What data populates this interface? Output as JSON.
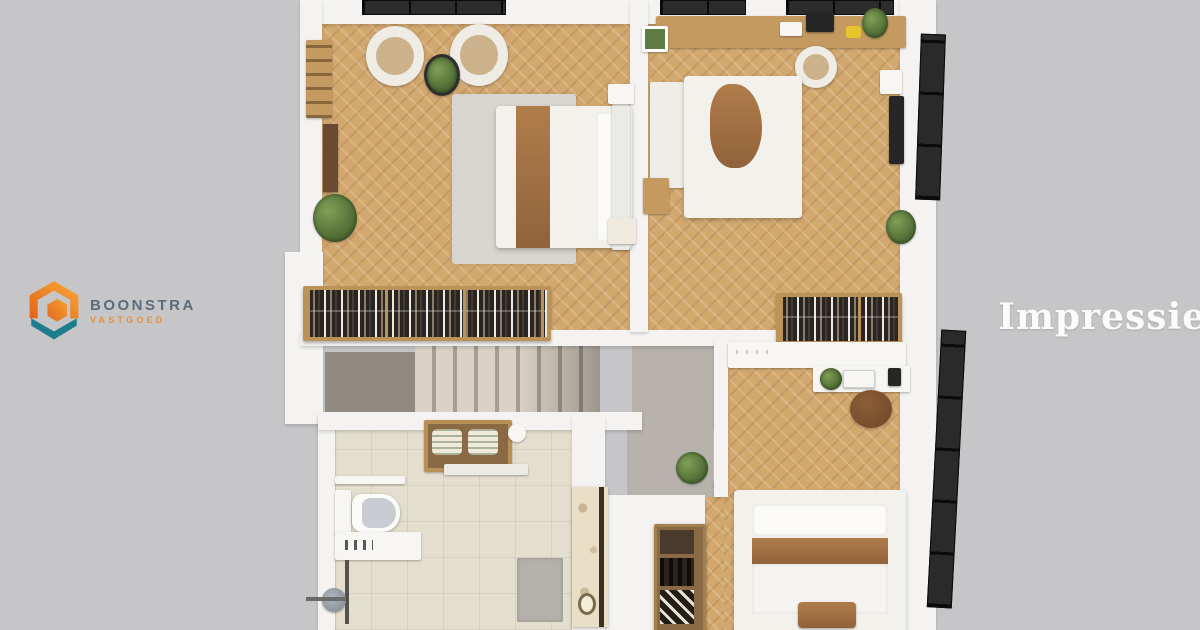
{
  "branding": {
    "company": "BOONSTRA",
    "division": "VASTGOED",
    "logo_icon": "hexagon-house-logo",
    "colors": {
      "orange": "#f0862c",
      "deep_orange": "#e2661e",
      "teal": "#1e7d8d",
      "company_text": "#5a6c7b",
      "division_text": "#e78f3c"
    }
  },
  "watermark": {
    "text": "Impressie",
    "color": "#fbfbfb"
  },
  "scene": {
    "type": "3d-floorplan-top-down-render",
    "background": "#c6c6c8",
    "palette": {
      "wall": "#f4f3f1",
      "wood_floor": "#d3a86f",
      "tile_floor": "#e4decf",
      "hall_floor": "#b7b2ab",
      "stairs": "#d9d2c5",
      "window_frame": "#1d1d1d",
      "wardrobe_wood": "#bb9257",
      "plant_green": "#5d7c44",
      "bed_linen": "#f3f1ec",
      "throw_brown": "#a97a4e"
    },
    "rooms": [
      {
        "name": "bedroom-top-left",
        "floor": "herringbone-wood",
        "contents": [
          "double bed with brown throw",
          "area rug",
          "two round lounge chairs",
          "small potted plant",
          "large plant",
          "nightstand",
          "foot bench",
          "open wardrobe with hanging clothes",
          "wooden ladder rack",
          "brown door"
        ]
      },
      {
        "name": "bedroom-top-right",
        "floor": "herringbone-wood",
        "contents": [
          "double bed with brown throw",
          "desk with laptop, papers and plant",
          "white desk chair",
          "wall mounted tv",
          "green wall frame",
          "side table with plant",
          "floor plant",
          "open wardrobe with hanging clothes"
        ]
      },
      {
        "name": "study-middle-right",
        "floor": "herringbone-wood",
        "contents": [
          "white sideboard",
          "desk with white laptop",
          "round brown stool",
          "desk plant"
        ]
      },
      {
        "name": "bedroom-bottom-right",
        "floor": "herringbone-wood",
        "contents": [
          "double bed with brown band",
          "foot bench",
          "wooden shelf unit with drawer, bottles and shoes",
          "plant on ledge",
          "patterned cabinet"
        ]
      },
      {
        "name": "bathroom",
        "floor": "beige-tile",
        "contents": [
          "wall hung toilet",
          "vanity with basin",
          "shower rail and head",
          "grab bar",
          "towel box with two rolled towels",
          "wall shelf",
          "grey shower mat"
        ]
      },
      {
        "name": "landing",
        "floor": "grey",
        "contents": [
          "staircase",
          "dark landing area"
        ]
      }
    ],
    "windows": [
      "three black window strips on top wall",
      "two tall black framed windows on right wall"
    ]
  }
}
